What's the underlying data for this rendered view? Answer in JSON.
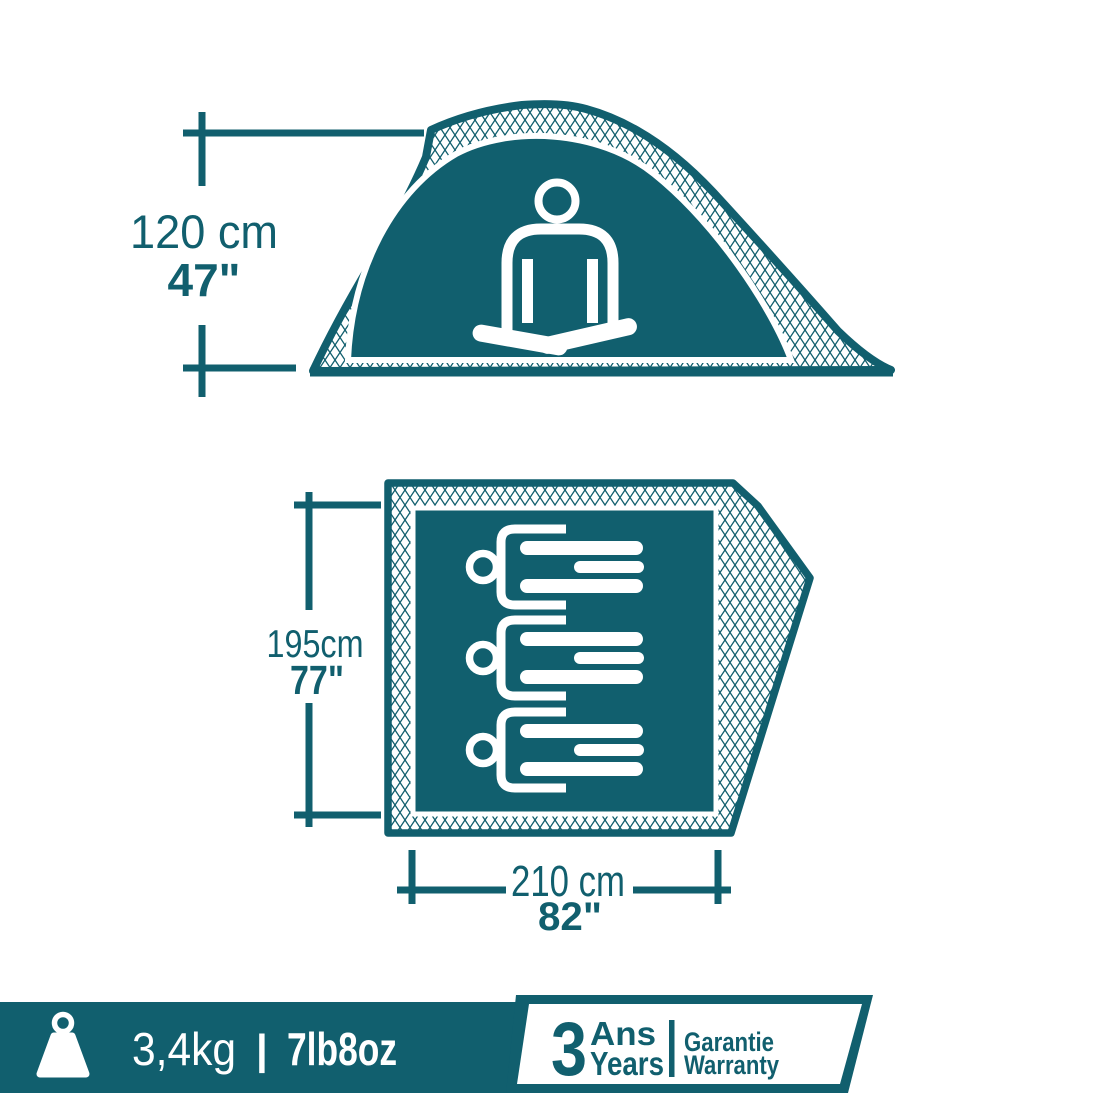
{
  "colors": {
    "teal": "#115F6E",
    "white": "#FFFFFF"
  },
  "side_view": {
    "height_cm": "120 cm",
    "height_in": "47\""
  },
  "floor_plan": {
    "depth_cm": "195cm",
    "depth_in": "77\"",
    "width_cm": "210 cm",
    "width_in": "82\""
  },
  "banner": {
    "weight_metric": "3,4kg",
    "separator": "|",
    "weight_imperial": "7lb8oz"
  },
  "warranty_badge": {
    "number": "3",
    "unit_fr": "Ans",
    "unit_en": "Years",
    "label_fr": "Garantie",
    "label_en": "Warranty"
  }
}
